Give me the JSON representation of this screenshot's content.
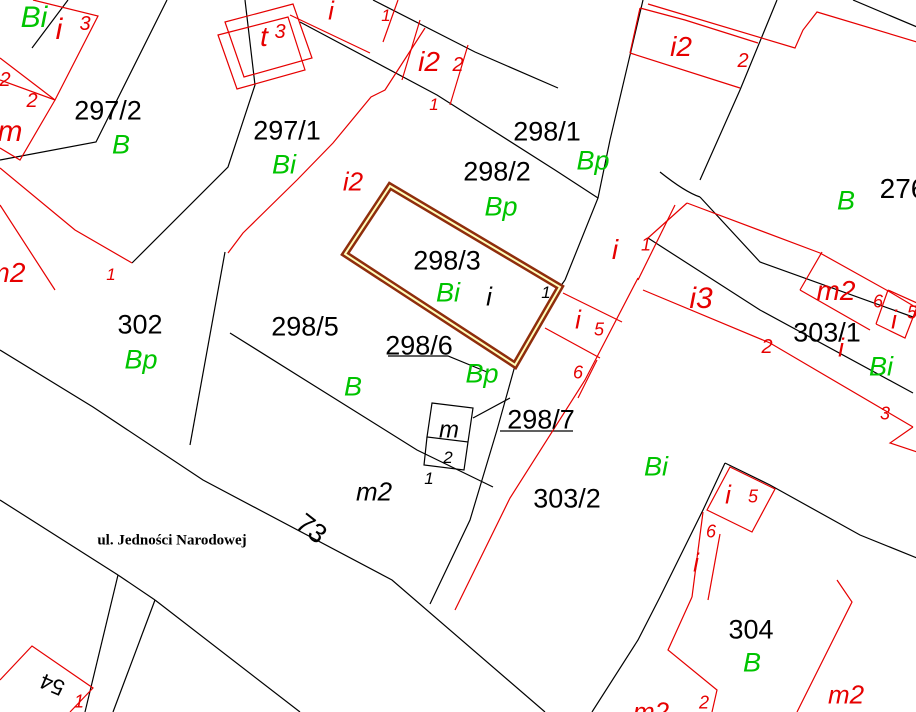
{
  "map": {
    "street_name": "ul. Jedności Narodowej",
    "highlighted_parcel": "298/3",
    "parcel_numbers": [
      "297/2",
      "297/1",
      "298/1",
      "298/2",
      "298/3",
      "298/5",
      "298/6",
      "298/7",
      "302",
      "303/1",
      "303/2",
      "304",
      "276",
      "73",
      "54"
    ],
    "colors": {
      "black": "#000000",
      "red": "#e60000",
      "green": "#00c400",
      "highlight_outer": "#8f2d0c",
      "highlight_inner": "#ffffbb",
      "bg": "#ffffff"
    },
    "highlight": {
      "parcel": "298/3",
      "path": "M390 186 L560 287 L515 365 L345 254 Z"
    },
    "lines": {
      "black": [
        "M68 0 L32 48",
        "M167 0 L96 142 L0 160",
        "M245 0 L255 85 L228 167 L132 263",
        "M225 252 L190 445",
        "M230 333 L417 450 L493 487",
        "M373 0 L475 52 L558 88",
        "M300 22 L437 95 L555 170 L598 198",
        "M643 0 L610 140 L598 198 L565 280",
        "M560 287 L565 280",
        "M777 0 L740 90 L700 180",
        "M660 172 Q685 192 700 197",
        "M700 197 L760 262 L913 317",
        "M648 238 L760 310 L913 393",
        "M853 0 L917 27",
        "M0 350 L93 407 L203 480 L392 580 L545 712",
        "M0 500 L118 575",
        "M118 575 L85 712",
        "M155 600 L113 712",
        "M118 575 L155 600",
        "M155 600 L300 712",
        "M725 463 L703 510 L660 597 L638 640 L592 712",
        "M725 463 L770 485 L860 535 L917 558",
        "M516 362 L497 430 L470 520 L430 604",
        "M432 403 L473 408 L468 442 L427 437 Z",
        "M427 437 L424 465 L464 470 L468 442",
        "M473 418 L510 398",
        "M388 356 L448 356 L487 372",
        "M500 431 L573 431"
      ],
      "red": [
        "M33 0 L98 16 L55 100 L0 80",
        "M0 58 L55 100",
        "M55 100 L20 160 L0 148",
        "M0 168 L75 230 L132 263",
        "M0 205 L55 290",
        "M225 22 L293 4 L312 58 L244 77 Z",
        "M218 35 L288 17 L305 70 L237 89 Z",
        "M425 28 L385 90 L371 97 L333 143 L297 180 L243 233 L228 253",
        "M398 0 L383 42",
        "M290 15 L370 53",
        "M420 20 L402 80",
        "M468 45 L450 105",
        "M640 8 L685 20 L758 43",
        "M630 53 L740 88",
        "M640 8 L630 53",
        "M648 4 L795 48 L803 30 L817 12 L917 42",
        "M687 203 L820 253 L890 292 L917 308",
        "M643 290 L770 343 L913 427",
        "M675 205 L638 280",
        "M648 238 L687 203",
        "M822 252 L800 290",
        "M800 290 L870 330",
        "M888 290 L917 303",
        "M876 324 L888 290",
        "M876 324 L905 338 L917 307",
        "M638 278 L585 380 L510 498 L455 610",
        "M563 293 L622 322",
        "M545 328 L600 358",
        "M597 360 L578 398",
        "M707 510 L730 467 L775 489 L752 532 Z",
        "M703 512 L692 597",
        "M720 534 L708 600",
        "M692 597 L668 650 L717 690 L712 712",
        "M837 580 L852 602 L797 712",
        "M913 427 L890 443 L917 452",
        "M0 680 L32 646 L93 688 L70 712"
      ]
    },
    "labels": [
      {
        "t": "297/2",
        "x": 108,
        "y": 110,
        "c": "k",
        "s": 27
      },
      {
        "t": "297/1",
        "x": 287,
        "y": 130,
        "c": "k",
        "s": 27
      },
      {
        "t": "298/1",
        "x": 547,
        "y": 131,
        "c": "k",
        "s": 27
      },
      {
        "t": "298/2",
        "x": 497,
        "y": 171,
        "c": "k",
        "s": 27
      },
      {
        "t": "298/3",
        "x": 447,
        "y": 260,
        "c": "k",
        "s": 27
      },
      {
        "t": "298/5",
        "x": 305,
        "y": 326,
        "c": "k",
        "s": 27
      },
      {
        "t": "298/6",
        "x": 419,
        "y": 345,
        "c": "k",
        "s": 27
      },
      {
        "t": "298/7",
        "x": 541,
        "y": 419,
        "c": "k",
        "s": 27
      },
      {
        "t": "302",
        "x": 140,
        "y": 324,
        "c": "k",
        "s": 27
      },
      {
        "t": "303/1",
        "x": 827,
        "y": 332,
        "c": "k",
        "s": 27
      },
      {
        "t": "303/2",
        "x": 567,
        "y": 498,
        "c": "k",
        "s": 27
      },
      {
        "t": "304",
        "x": 751,
        "y": 629,
        "c": "k",
        "s": 27
      },
      {
        "t": "276",
        "x": 903,
        "y": 188,
        "c": "k",
        "s": 28
      },
      {
        "t": "73",
        "x": 312,
        "y": 528,
        "c": "k",
        "s": 27,
        "r": 38
      },
      {
        "t": "54",
        "x": 52,
        "y": 685,
        "c": "k",
        "s": 22,
        "r": 203
      },
      {
        "t": "ul. Jedności Narodowej",
        "x": 172,
        "y": 539,
        "c": "k",
        "s": 15,
        "f": "serif",
        "w": "bold"
      },
      {
        "t": "i",
        "x": 489,
        "y": 296,
        "c": "k",
        "s": 26,
        "i": 1
      },
      {
        "t": "1",
        "x": 546,
        "y": 292,
        "c": "k",
        "s": 17,
        "i": 1
      },
      {
        "t": "m",
        "x": 449,
        "y": 429,
        "c": "k",
        "s": 24,
        "i": 1
      },
      {
        "t": "2",
        "x": 448,
        "y": 457,
        "c": "k",
        "s": 17,
        "i": 1
      },
      {
        "t": "1",
        "x": 429,
        "y": 478,
        "c": "k",
        "s": 17,
        "i": 1
      },
      {
        "t": "m2",
        "x": 374,
        "y": 491,
        "c": "k",
        "s": 26,
        "i": 1
      },
      {
        "t": "Bi",
        "x": 34,
        "y": 16,
        "c": "g",
        "s": 30,
        "i": 1
      },
      {
        "t": "B",
        "x": 121,
        "y": 144,
        "c": "g",
        "s": 27,
        "i": 1
      },
      {
        "t": "Bi",
        "x": 284,
        "y": 164,
        "c": "g",
        "s": 27,
        "i": 1
      },
      {
        "t": "Bp",
        "x": 593,
        "y": 160,
        "c": "g",
        "s": 27,
        "i": 1
      },
      {
        "t": "Bp",
        "x": 501,
        "y": 206,
        "c": "g",
        "s": 27,
        "i": 1
      },
      {
        "t": "Bi",
        "x": 448,
        "y": 292,
        "c": "g",
        "s": 27,
        "i": 1
      },
      {
        "t": "Bp",
        "x": 141,
        "y": 359,
        "c": "g",
        "s": 27,
        "i": 1
      },
      {
        "t": "B",
        "x": 353,
        "y": 386,
        "c": "g",
        "s": 27,
        "i": 1
      },
      {
        "t": "Bp",
        "x": 482,
        "y": 373,
        "c": "g",
        "s": 27,
        "i": 1
      },
      {
        "t": "B",
        "x": 846,
        "y": 200,
        "c": "g",
        "s": 27,
        "i": 1
      },
      {
        "t": "Bi",
        "x": 656,
        "y": 466,
        "c": "g",
        "s": 27,
        "i": 1
      },
      {
        "t": "Bi",
        "x": 881,
        "y": 366,
        "c": "g",
        "s": 27,
        "i": 1
      },
      {
        "t": "B",
        "x": 752,
        "y": 662,
        "c": "g",
        "s": 27,
        "i": 1
      },
      {
        "t": "i",
        "x": 59,
        "y": 28,
        "c": "r",
        "s": 30,
        "i": 1
      },
      {
        "t": "3",
        "x": 85,
        "y": 23,
        "c": "r",
        "s": 20,
        "i": 1
      },
      {
        "t": "2",
        "x": 5,
        "y": 79,
        "c": "r",
        "s": 20,
        "i": 1
      },
      {
        "t": "2",
        "x": 32,
        "y": 100,
        "c": "r",
        "s": 20,
        "i": 1
      },
      {
        "t": "m",
        "x": 10,
        "y": 130,
        "c": "r",
        "s": 30,
        "i": 1
      },
      {
        "t": "m2",
        "x": 6,
        "y": 272,
        "c": "r",
        "s": 28,
        "i": 1
      },
      {
        "t": "1",
        "x": 111,
        "y": 274,
        "c": "r",
        "s": 17,
        "i": 1
      },
      {
        "t": "t",
        "x": 264,
        "y": 36,
        "c": "r",
        "s": 28,
        "i": 1
      },
      {
        "t": "3",
        "x": 280,
        "y": 31,
        "c": "r",
        "s": 20,
        "i": 1
      },
      {
        "t": "i",
        "x": 331,
        "y": 10,
        "c": "r",
        "s": 26,
        "i": 1
      },
      {
        "t": "1",
        "x": 386,
        "y": 15,
        "c": "r",
        "s": 17,
        "i": 1
      },
      {
        "t": "i2",
        "x": 429,
        "y": 61,
        "c": "r",
        "s": 28,
        "i": 1
      },
      {
        "t": "2",
        "x": 458,
        "y": 64,
        "c": "r",
        "s": 20,
        "i": 1
      },
      {
        "t": "1",
        "x": 434,
        "y": 104,
        "c": "r",
        "s": 17,
        "i": 1
      },
      {
        "t": "i2",
        "x": 681,
        "y": 46,
        "c": "r",
        "s": 28,
        "i": 1
      },
      {
        "t": "2",
        "x": 743,
        "y": 60,
        "c": "r",
        "s": 20,
        "i": 1
      },
      {
        "t": "i2",
        "x": 353,
        "y": 181,
        "c": "r",
        "s": 26,
        "i": 1
      },
      {
        "t": "i",
        "x": 615,
        "y": 249,
        "c": "r",
        "s": 28,
        "i": 1
      },
      {
        "t": "1",
        "x": 646,
        "y": 244,
        "c": "r",
        "s": 18,
        "i": 1
      },
      {
        "t": "i3",
        "x": 701,
        "y": 297,
        "c": "r",
        "s": 30,
        "i": 1
      },
      {
        "t": "2",
        "x": 767,
        "y": 346,
        "c": "r",
        "s": 20,
        "i": 1
      },
      {
        "t": "i",
        "x": 578,
        "y": 319,
        "c": "r",
        "s": 26,
        "i": 1
      },
      {
        "t": "5",
        "x": 599,
        "y": 329,
        "c": "r",
        "s": 18,
        "i": 1
      },
      {
        "t": "6",
        "x": 578,
        "y": 372,
        "c": "r",
        "s": 18,
        "i": 1
      },
      {
        "t": "m2",
        "x": 836,
        "y": 290,
        "c": "r",
        "s": 28,
        "i": 1
      },
      {
        "t": "6",
        "x": 878,
        "y": 301,
        "c": "r",
        "s": 18,
        "i": 1
      },
      {
        "t": "i",
        "x": 894,
        "y": 319,
        "c": "r",
        "s": 26,
        "i": 1
      },
      {
        "t": "5",
        "x": 912,
        "y": 312,
        "c": "r",
        "s": 18,
        "i": 1
      },
      {
        "t": "i",
        "x": 841,
        "y": 347,
        "c": "r",
        "s": 26,
        "i": 1
      },
      {
        "t": "3",
        "x": 885,
        "y": 413,
        "c": "r",
        "s": 18,
        "i": 1
      },
      {
        "t": "i",
        "x": 728,
        "y": 494,
        "c": "r",
        "s": 26,
        "i": 1
      },
      {
        "t": "5",
        "x": 753,
        "y": 496,
        "c": "r",
        "s": 18,
        "i": 1
      },
      {
        "t": "6",
        "x": 711,
        "y": 531,
        "c": "r",
        "s": 18,
        "i": 1
      },
      {
        "t": "i",
        "x": 696,
        "y": 562,
        "c": "r",
        "s": 26,
        "i": 1
      },
      {
        "t": "2",
        "x": 704,
        "y": 702,
        "c": "r",
        "s": 18,
        "i": 1
      },
      {
        "t": "m2",
        "x": 651,
        "y": 711,
        "c": "r",
        "s": 26,
        "i": 1
      },
      {
        "t": "m2",
        "x": 846,
        "y": 694,
        "c": "r",
        "s": 26,
        "i": 1
      },
      {
        "t": "1",
        "x": 79,
        "y": 701,
        "c": "r",
        "s": 18,
        "i": 1
      }
    ]
  }
}
